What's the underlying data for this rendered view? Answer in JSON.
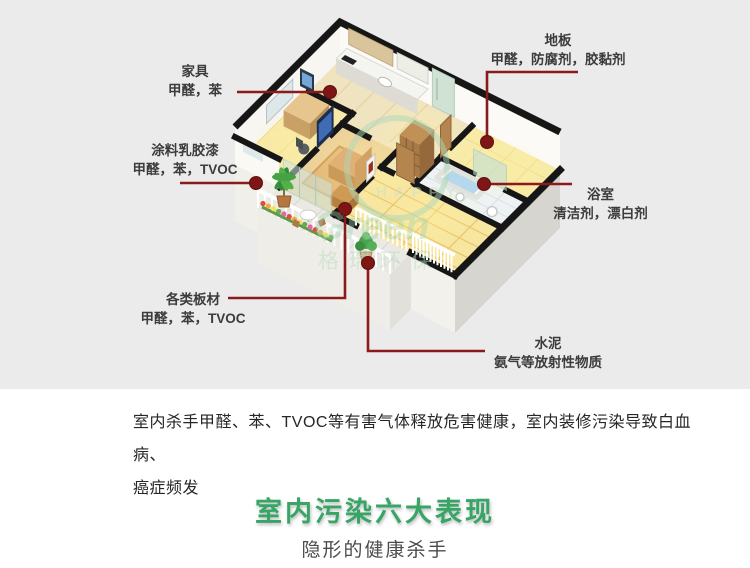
{
  "callouts": [
    {
      "id": "furniture",
      "title": "家具",
      "substances": "甲醛，苯"
    },
    {
      "id": "paint",
      "title": "涂料乳胶漆",
      "substances": "甲醛，苯，TVOC"
    },
    {
      "id": "floorboard",
      "title": "地板",
      "substances": "甲醛，防腐剂，胶黏剂"
    },
    {
      "id": "bathroom",
      "title": "浴室",
      "substances": "清洁剂，漂白剂"
    },
    {
      "id": "boards",
      "title": "各类板材",
      "substances": "甲醛，苯，TVOC"
    },
    {
      "id": "cement",
      "title": "水泥",
      "substances": "氨气等放射性物质"
    }
  ],
  "description": {
    "line1": "室内杀手甲醛、苯、TVOC等有害气体释放危害健康，室内装修污染导致白血病、",
    "line2": "癌症频发"
  },
  "section": {
    "heading": "室内污染六大表现",
    "subheading": "隐形的健康杀手"
  },
  "watermark": {
    "circle_text": "HAPPY",
    "brand": "Green",
    "brand_cn": "格瑞环保"
  },
  "colors": {
    "callout_line": "#8b1a1a",
    "callout_dot": "#7e1616",
    "heading_green": "#36a566",
    "background_gray": "#ebebeb",
    "wall_black": "#161616"
  }
}
